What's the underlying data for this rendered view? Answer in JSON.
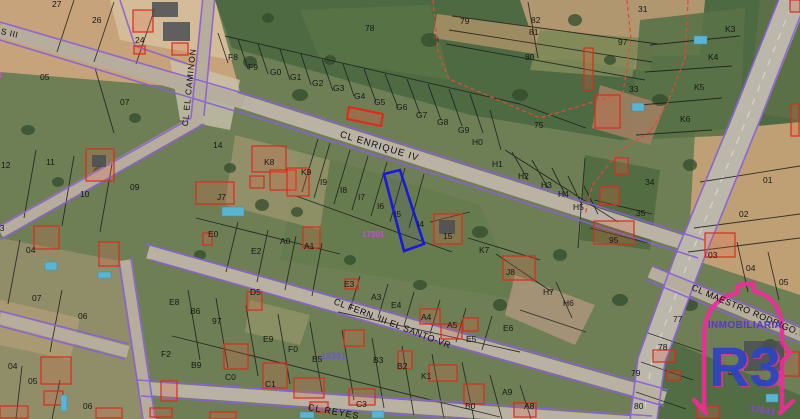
{
  "map": {
    "streets": [
      {
        "t": "S III",
        "x": 1,
        "y": 27,
        "rot": 13,
        "fs": 8.5,
        "ls": 0.5
      },
      {
        "t": "CL EL CAMINON",
        "x": 185,
        "y": 122,
        "rot": -84,
        "fs": 8.5,
        "ls": 1
      },
      {
        "t": "CL ENRIQUE IV",
        "x": 340,
        "y": 130,
        "rot": 17,
        "fs": 9.5,
        "ls": 1
      },
      {
        "t": "CL FERN. III EL SANTO-VR",
        "x": 334,
        "y": 297,
        "rot": 21,
        "fs": 9,
        "ls": 0.5
      },
      {
        "t": "CL MAESTRO RODRIGO.VA",
        "x": 692,
        "y": 283,
        "rot": 23,
        "fs": 9,
        "ls": 0.5
      },
      {
        "t": "CL REYES",
        "x": 308,
        "y": 403,
        "rot": 10,
        "fs": 9,
        "ls": 1
      }
    ],
    "parcel_labels": [
      {
        "t": "27",
        "x": 52,
        "y": 0
      },
      {
        "t": "26",
        "x": 92,
        "y": 16
      },
      {
        "t": "24",
        "x": 135,
        "y": 36
      },
      {
        "t": "05",
        "x": 40,
        "y": 73
      },
      {
        "t": "07",
        "x": 120,
        "y": 98
      },
      {
        "t": "12",
        "x": 1,
        "y": 161
      },
      {
        "t": "11",
        "x": 46,
        "y": 158
      },
      {
        "t": "10",
        "x": 80,
        "y": 190
      },
      {
        "t": "09",
        "x": 130,
        "y": 183
      },
      {
        "t": "03",
        "x": -5,
        "y": 224
      },
      {
        "t": "04",
        "x": 26,
        "y": 246
      },
      {
        "t": "07",
        "x": 32,
        "y": 294
      },
      {
        "t": "06",
        "x": 78,
        "y": 312
      },
      {
        "t": "04",
        "x": 8,
        "y": 362
      },
      {
        "t": "05",
        "x": 28,
        "y": 377
      },
      {
        "t": "06",
        "x": 83,
        "y": 402
      },
      {
        "t": "F8",
        "x": 228,
        "y": 53
      },
      {
        "t": "F9",
        "x": 248,
        "y": 63
      },
      {
        "t": "G0",
        "x": 270,
        "y": 68
      },
      {
        "t": "G1",
        "x": 290,
        "y": 73
      },
      {
        "t": "G2",
        "x": 312,
        "y": 79
      },
      {
        "t": "G3",
        "x": 333,
        "y": 84
      },
      {
        "t": "G4",
        "x": 354,
        "y": 92
      },
      {
        "t": "G5",
        "x": 374,
        "y": 98
      },
      {
        "t": "G6",
        "x": 396,
        "y": 103
      },
      {
        "t": "G7",
        "x": 416,
        "y": 111
      },
      {
        "t": "G8",
        "x": 437,
        "y": 118
      },
      {
        "t": "G9",
        "x": 458,
        "y": 126
      },
      {
        "t": "H0",
        "x": 472,
        "y": 138
      },
      {
        "t": "H1",
        "x": 492,
        "y": 160
      },
      {
        "t": "H2",
        "x": 518,
        "y": 172
      },
      {
        "t": "H3",
        "x": 541,
        "y": 181
      },
      {
        "t": "H4",
        "x": 558,
        "y": 190
      },
      {
        "t": "H5",
        "x": 573,
        "y": 203
      },
      {
        "t": "78",
        "x": 365,
        "y": 24
      },
      {
        "t": "79",
        "x": 460,
        "y": 17
      },
      {
        "t": "82",
        "x": 531,
        "y": 16
      },
      {
        "t": "81",
        "x": 529,
        "y": 28
      },
      {
        "t": "80",
        "x": 525,
        "y": 53
      },
      {
        "t": "31",
        "x": 638,
        "y": 5
      },
      {
        "t": "97",
        "x": 618,
        "y": 38
      },
      {
        "t": "33",
        "x": 629,
        "y": 85
      },
      {
        "t": "75",
        "x": 534,
        "y": 121
      },
      {
        "t": "K3",
        "x": 725,
        "y": 25
      },
      {
        "t": "K4",
        "x": 708,
        "y": 53
      },
      {
        "t": "K5",
        "x": 694,
        "y": 83
      },
      {
        "t": "K6",
        "x": 680,
        "y": 115
      },
      {
        "t": "14",
        "x": 213,
        "y": 141
      },
      {
        "t": "K8",
        "x": 264,
        "y": 158
      },
      {
        "t": "K9",
        "x": 301,
        "y": 168
      },
      {
        "t": "J7",
        "x": 217,
        "y": 193
      },
      {
        "t": "I9",
        "x": 320,
        "y": 178
      },
      {
        "t": "I8",
        "x": 340,
        "y": 186
      },
      {
        "t": "I7",
        "x": 358,
        "y": 193
      },
      {
        "t": "I6",
        "x": 377,
        "y": 202
      },
      {
        "t": "I5",
        "x": 394,
        "y": 210
      },
      {
        "t": "I4",
        "x": 417,
        "y": 220
      },
      {
        "t": "E0",
        "x": 208,
        "y": 230
      },
      {
        "t": "E2",
        "x": 251,
        "y": 247
      },
      {
        "t": "A0",
        "x": 280,
        "y": 237
      },
      {
        "t": "A1",
        "x": 304,
        "y": 242
      },
      {
        "t": "15",
        "x": 443,
        "y": 232
      },
      {
        "t": "K7",
        "x": 479,
        "y": 246
      },
      {
        "t": "J8",
        "x": 506,
        "y": 268
      },
      {
        "t": "H7",
        "x": 543,
        "y": 288
      },
      {
        "t": "H6",
        "x": 563,
        "y": 299
      },
      {
        "t": "34",
        "x": 645,
        "y": 178
      },
      {
        "t": "35",
        "x": 636,
        "y": 209
      },
      {
        "t": "95",
        "x": 609,
        "y": 236
      },
      {
        "t": "01",
        "x": 763,
        "y": 176
      },
      {
        "t": "02",
        "x": 739,
        "y": 210
      },
      {
        "t": "03",
        "x": 708,
        "y": 251
      },
      {
        "t": "04",
        "x": 746,
        "y": 264
      },
      {
        "t": "05",
        "x": 779,
        "y": 278
      },
      {
        "t": "E3",
        "x": 344,
        "y": 280
      },
      {
        "t": "A3",
        "x": 371,
        "y": 293
      },
      {
        "t": "E4",
        "x": 391,
        "y": 301
      },
      {
        "t": "A4",
        "x": 421,
        "y": 313
      },
      {
        "t": "A5",
        "x": 447,
        "y": 321
      },
      {
        "t": "E5",
        "x": 466,
        "y": 335
      },
      {
        "t": "E6",
        "x": 503,
        "y": 324
      },
      {
        "t": "E8",
        "x": 169,
        "y": 298
      },
      {
        "t": "B6",
        "x": 190,
        "y": 307
      },
      {
        "t": "D5",
        "x": 250,
        "y": 288
      },
      {
        "t": "97",
        "x": 212,
        "y": 317
      },
      {
        "t": "E9",
        "x": 263,
        "y": 335
      },
      {
        "t": "F0",
        "x": 288,
        "y": 345
      },
      {
        "t": "B5",
        "x": 312,
        "y": 355
      },
      {
        "t": "B3",
        "x": 373,
        "y": 356
      },
      {
        "t": "B2",
        "x": 397,
        "y": 362
      },
      {
        "t": "K1",
        "x": 421,
        "y": 372
      },
      {
        "t": "F2",
        "x": 161,
        "y": 350
      },
      {
        "t": "B9",
        "x": 191,
        "y": 361
      },
      {
        "t": "C0",
        "x": 225,
        "y": 373
      },
      {
        "t": "C1",
        "x": 265,
        "y": 380
      },
      {
        "t": "C3",
        "x": 356,
        "y": 400
      },
      {
        "t": "B0",
        "x": 465,
        "y": 402
      },
      {
        "t": "A9",
        "x": 502,
        "y": 388
      },
      {
        "t": "A8",
        "x": 524,
        "y": 402
      },
      {
        "t": "77",
        "x": 673,
        "y": 315
      },
      {
        "t": "78",
        "x": 658,
        "y": 343
      },
      {
        "t": "79",
        "x": 631,
        "y": 369
      },
      {
        "t": "80",
        "x": 634,
        "y": 402
      },
      {
        "t": "01",
        "x": 728,
        "y": 368
      },
      {
        "t": "02",
        "x": 757,
        "y": 379
      }
    ],
    "block_labels": [
      {
        "t": "17301",
        "x": 362,
        "y": 231,
        "c": "#c04ed8",
        "fs": 8
      },
      {
        "t": "18301",
        "x": 321,
        "y": 352,
        "c": "#6d53d6",
        "fs": 9
      },
      {
        "t": "17643",
        "x": 750,
        "y": 404,
        "c": "#8a46d0",
        "fs": 9,
        "rot": 10
      },
      {
        "t": "14",
        "x": -7,
        "y": 72,
        "c": "#d649c8",
        "fs": 8
      }
    ],
    "selected_parcel": {
      "points": "384,174 400,170 424,244 404,251",
      "color": "#1a18e0"
    },
    "secondary_highlight": {
      "points": "349,107 383,114 381,126 347,119",
      "color": "#e8251a"
    }
  },
  "watermark": {
    "tagline": "INMOBILIARIA",
    "brand": "R3"
  },
  "colors": {
    "cadastral_purple": "#8a5fd8",
    "building_red": "#da2c1c",
    "rural_dashed_red": "#e04a38",
    "highlight_blue": "#1a18e0",
    "highlight_red": "#e8251a",
    "logo_pink": "#f02b9a",
    "logo_blue": "#2e43c4",
    "pool_blue": "#58b6d2"
  }
}
